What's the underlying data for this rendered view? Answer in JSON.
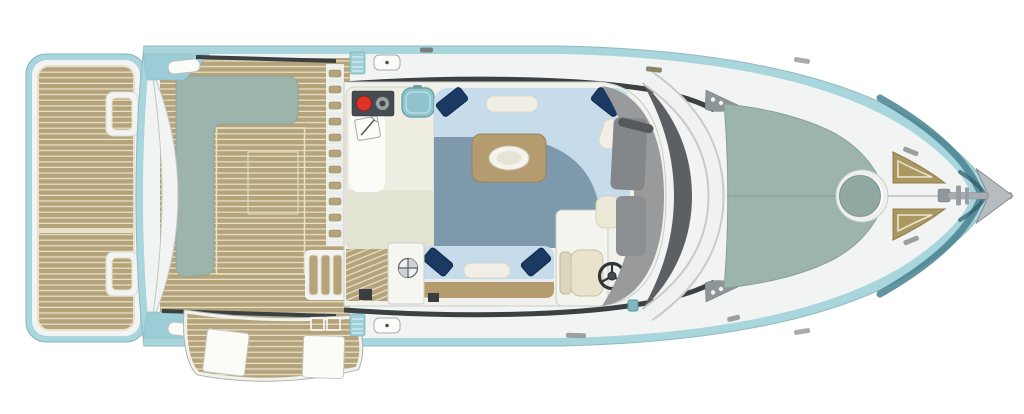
{
  "scene": {
    "description": "Top-down deck plan of a motor yacht, stern with swim platform on the left, bow with anchor pointing right",
    "text_content": "none (drawing contains no text labels)"
  },
  "colors": {
    "page_bg": "#ffffff",
    "hull_aqua": "#a9d6dd",
    "hull_aqua_strip": "#9ccdd6",
    "bow_teal": "#49818f",
    "bow_teal_dark": "#2e5a66",
    "deck_white": "#f2f4f3",
    "teak": "#b5a47b",
    "teak_line": "#e9e2c9",
    "sage": "#9db4ad",
    "sage_dark": "#91a8a2",
    "sofa_blue": "#c6dcea",
    "floor_blue": "#7e99ac",
    "pillow_navy": "#1b3a63",
    "bolster": "#f1efe5",
    "table_tan": "#b49c70",
    "counter": "#efeee2",
    "counter_lower": "#e2e3d3",
    "stove_dark": "#454b51",
    "burner_red": "#e03227",
    "sink_teal": "#8fc4cd",
    "seat_cream": "#e9e3cb",
    "dash_light": "#989a9c",
    "dash_dark": "#5d6062",
    "line_dark": "#3b4043",
    "metal_gray": "#a7adb1",
    "bracket_gray": "#8e9597",
    "white_panel": "#fbfbf8"
  },
  "components": {
    "swim_platform": "teak swim platform",
    "aft_lounge": "sage-green aft lounge / transom seat",
    "cockpit_deck": "teak cockpit deck",
    "terrace": "fold-out teak side terrace with white panels",
    "galley": "galley with stove, sink and chart pad",
    "salon_sofa": "U-shaped salon sofa with pillows",
    "coffee_table": "coffee table with oval dish",
    "aft_bench": "aft-facing bench seat",
    "helm": "helm seat and steering wheel",
    "dashboard": "helm dashboard and windshield",
    "bow_sunpad": "bow sunpad with round hatch",
    "bow_triangles": "bow teak step pads",
    "anchor": "bow anchor"
  }
}
